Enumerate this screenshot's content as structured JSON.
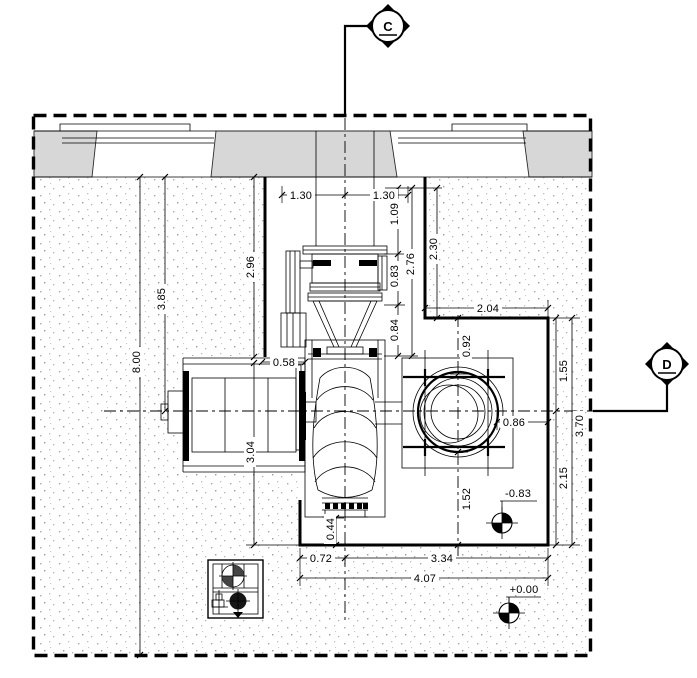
{
  "drawing": {
    "title": "pump station plan view",
    "section_markers": {
      "c": "C",
      "d": "D"
    },
    "levels": {
      "upper": "-0.83",
      "datum": "+0.00"
    },
    "dims": {
      "w130l": "1.30",
      "w130r": "1.30",
      "v109": "1.09",
      "v083": "0.83",
      "v084": "0.84",
      "v276": "2.76",
      "v230": "2.30",
      "v296": "2.96",
      "v385": "3.85",
      "v800": "8.00",
      "v304": "3.04",
      "h204": "2.04",
      "v092": "0.92",
      "v155": "1.55",
      "h086": "0.86",
      "v370": "3.70",
      "v215": "2.15",
      "v152": "1.52",
      "v044": "0.44",
      "h058": "0.58",
      "h072": "0.72",
      "h334": "3.34",
      "h407": "4.07"
    },
    "colors": {
      "line": "#000000",
      "wall_fill": "#d7d7d7",
      "stipple": "#a9a9a9",
      "background": "#ffffff"
    }
  }
}
